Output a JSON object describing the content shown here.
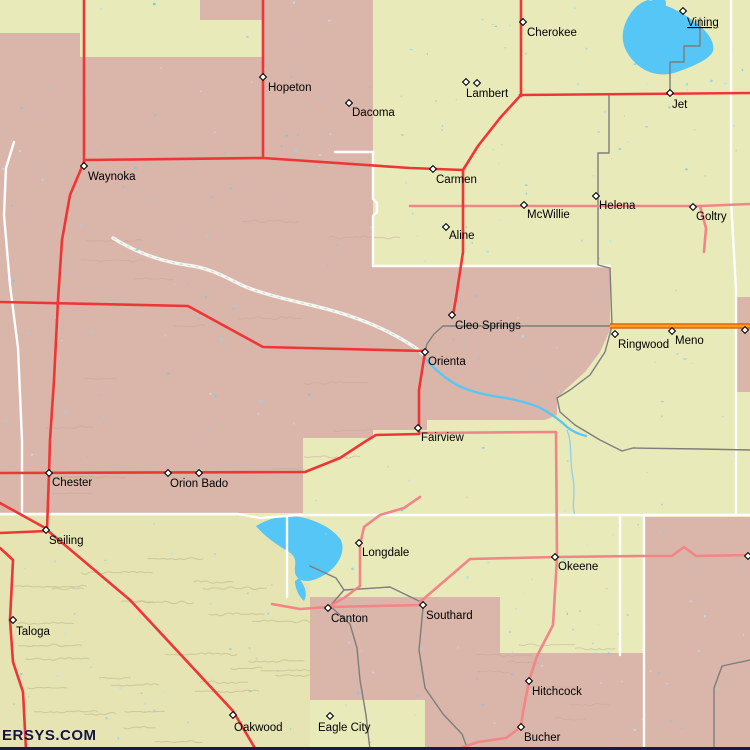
{
  "watermark": {
    "text": "ERSYS.COM"
  },
  "map": {
    "towns": [
      {
        "name": "Cherokee",
        "x": 523,
        "y": 22,
        "dx": 4,
        "dy": 14
      },
      {
        "name": "Vining",
        "x": 683,
        "y": 11,
        "dx": 4,
        "dy": 15,
        "link": true
      },
      {
        "name": "Jet",
        "x": 670,
        "y": 93,
        "dx": 2,
        "dy": 15
      },
      {
        "name": "Lambert",
        "x": 477,
        "y": 83,
        "dx": -11,
        "dy": 14
      },
      {
        "name": "Hopeton",
        "x": 263,
        "y": 77,
        "dx": 5,
        "dy": 14
      },
      {
        "name": "Dacoma",
        "x": 349,
        "y": 103,
        "dx": 3,
        "dy": 13
      },
      {
        "name": "Waynoka",
        "x": 84,
        "y": 166,
        "dx": 4,
        "dy": 14
      },
      {
        "name": "Carmen",
        "x": 433,
        "y": 169,
        "dx": 3,
        "dy": 14
      },
      {
        "name": "McWillie",
        "x": 524,
        "y": 205,
        "dx": 3,
        "dy": 13
      },
      {
        "name": "Helena",
        "x": 596,
        "y": 196,
        "dx": 3,
        "dy": 13
      },
      {
        "name": "Goltry",
        "x": 693,
        "y": 207,
        "dx": 3,
        "dy": 13
      },
      {
        "name": "Aline",
        "x": 446,
        "y": 227,
        "dx": 3,
        "dy": 12
      },
      {
        "name": "Cleo Springs",
        "x": 452,
        "y": 315,
        "dx": 3,
        "dy": 14
      },
      {
        "name": "Ringwood",
        "x": 615,
        "y": 334,
        "dx": 3,
        "dy": 14
      },
      {
        "name": "Meno",
        "x": 672,
        "y": 331,
        "dx": 3,
        "dy": 13
      },
      {
        "name": "Orienta",
        "x": 425,
        "y": 352,
        "dx": 3,
        "dy": 13
      },
      {
        "name": "Fairview",
        "x": 418,
        "y": 428,
        "dx": 3,
        "dy": 13
      },
      {
        "name": "Chester",
        "x": 49,
        "y": 473,
        "dx": 3,
        "dy": 13
      },
      {
        "name": "Orion Bado",
        "x": 168,
        "y": 473,
        "dx": 2,
        "dy": 14
      },
      {
        "name": "Seiling",
        "x": 46,
        "y": 530,
        "dx": 3,
        "dy": 14
      },
      {
        "name": "Longdale",
        "x": 359,
        "y": 543,
        "dx": 3,
        "dy": 13
      },
      {
        "name": "Okeene",
        "x": 555,
        "y": 557,
        "dx": 3,
        "dy": 13
      },
      {
        "name": "Canton",
        "x": 328,
        "y": 608,
        "dx": 3,
        "dy": 14
      },
      {
        "name": "Southard",
        "x": 423,
        "y": 605,
        "dx": 3,
        "dy": 14
      },
      {
        "name": "Taloga",
        "x": 13,
        "y": 620,
        "dx": 3,
        "dy": 15
      },
      {
        "name": "Oakwood",
        "x": 233,
        "y": 715,
        "dx": 1,
        "dy": 16
      },
      {
        "name": "Eagle City",
        "x": 330,
        "y": 716,
        "dx": -12,
        "dy": 15
      },
      {
        "name": "Hitchcock",
        "x": 529,
        "y": 681,
        "dx": 3,
        "dy": 14
      },
      {
        "name": "Bucher",
        "x": 521,
        "y": 727,
        "dx": 3,
        "dy": 14
      }
    ],
    "extra_markers": [
      {
        "x": 466,
        "y": 82
      },
      {
        "x": 199,
        "y": 473
      },
      {
        "x": 745,
        "y": 330
      },
      {
        "x": 748,
        "y": 556
      }
    ],
    "colors": {
      "land_yellow": "#e9eaba",
      "land_pink": "#dab6aa",
      "water": "#55c6f5",
      "road_red": "#ee3636",
      "road_salmon": "#f28585",
      "road_orange": "#ff9d1e",
      "road_orange_edge": "#cc4f00",
      "road_gray": "#7d7d7d",
      "road_white": "#ffffff",
      "label": "#000000",
      "watermark": "#14143c"
    }
  }
}
